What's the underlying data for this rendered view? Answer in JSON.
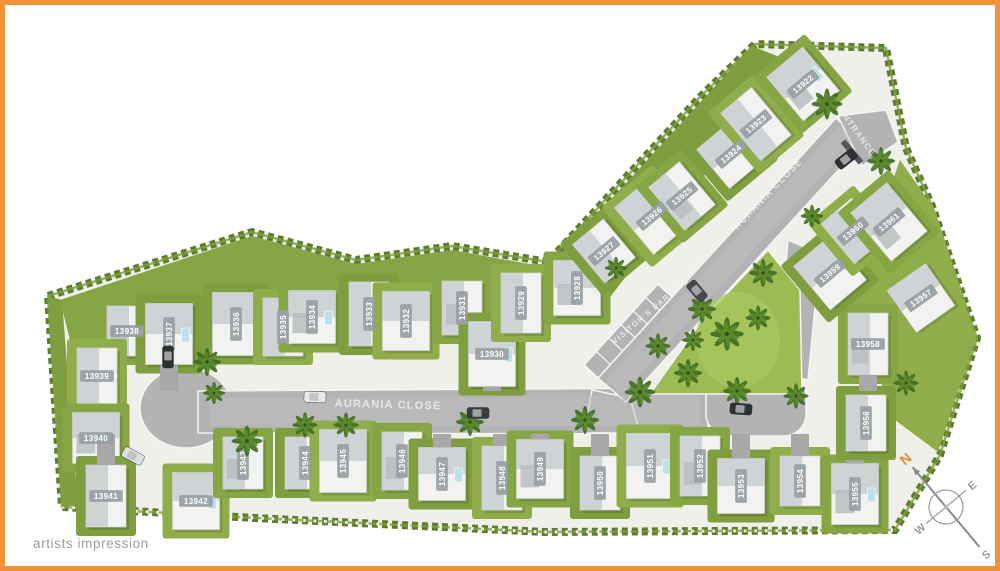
{
  "page": {
    "footer_note": "artists impression",
    "frame_color": "#ef9238",
    "background": "#ffffff"
  },
  "plan": {
    "streets": [
      {
        "name": "AURANIA CLOSE",
        "x": 388,
        "y": 408,
        "rotation": 1.5,
        "size": 11
      },
      {
        "name": "AURANIA CLOSE",
        "x": 770,
        "y": 196,
        "rotation": -46,
        "size": 9.5
      },
      {
        "name": "ENTRANCE",
        "x": 855,
        "y": 134,
        "rotation": 54,
        "size": 8.5
      },
      {
        "name": "VISITOR'S PARKING",
        "x": 652,
        "y": 313,
        "rotation": -40,
        "size": 8
      }
    ],
    "compass": {
      "n": "N",
      "e": "E",
      "s": "S",
      "w": "W",
      "north_color": "#e08a3a",
      "x": 946,
      "y": 507,
      "rotation": -40
    },
    "lots": [
      {
        "id": "13938",
        "x": 127,
        "y": 331,
        "r": 0
      },
      {
        "id": "13937",
        "x": 169,
        "y": 334,
        "r": -90
      },
      {
        "id": "13939",
        "x": 97,
        "y": 376,
        "r": 0
      },
      {
        "id": "13940",
        "x": 96,
        "y": 438,
        "r": 0
      },
      {
        "id": "13941",
        "x": 106,
        "y": 496,
        "r": 0
      },
      {
        "id": "13942",
        "x": 196,
        "y": 501,
        "r": 0
      },
      {
        "id": "13943",
        "x": 243,
        "y": 463,
        "r": -90
      },
      {
        "id": "13936",
        "x": 236,
        "y": 324,
        "r": -90
      },
      {
        "id": "13935",
        "x": 283,
        "y": 327,
        "r": -90
      },
      {
        "id": "13934",
        "x": 312,
        "y": 317,
        "r": -90
      },
      {
        "id": "13933",
        "x": 369,
        "y": 314,
        "r": -90
      },
      {
        "id": "13932",
        "x": 406,
        "y": 321,
        "r": -90
      },
      {
        "id": "13931",
        "x": 462,
        "y": 308,
        "r": -90
      },
      {
        "id": "13930",
        "x": 492,
        "y": 354,
        "r": 0
      },
      {
        "id": "13929",
        "x": 521,
        "y": 303,
        "r": -90
      },
      {
        "id": "13928",
        "x": 577,
        "y": 288,
        "r": -90
      },
      {
        "id": "13927",
        "x": 604,
        "y": 251,
        "r": -40
      },
      {
        "id": "13926",
        "x": 652,
        "y": 216,
        "r": -40
      },
      {
        "id": "13925",
        "x": 682,
        "y": 196,
        "r": -40
      },
      {
        "id": "13924",
        "x": 731,
        "y": 154,
        "r": -40
      },
      {
        "id": "13923",
        "x": 756,
        "y": 124,
        "r": -40
      },
      {
        "id": "13922",
        "x": 803,
        "y": 84,
        "r": -40
      },
      {
        "id": "13944",
        "x": 305,
        "y": 463,
        "r": -90
      },
      {
        "id": "13945",
        "x": 343,
        "y": 461,
        "r": -90
      },
      {
        "id": "13946",
        "x": 402,
        "y": 461,
        "r": -90
      },
      {
        "id": "13947",
        "x": 442,
        "y": 474,
        "r": -90
      },
      {
        "id": "13948",
        "x": 502,
        "y": 478,
        "r": -90
      },
      {
        "id": "13949",
        "x": 540,
        "y": 469,
        "r": -90
      },
      {
        "id": "13950",
        "x": 600,
        "y": 483,
        "r": -90
      },
      {
        "id": "13951",
        "x": 650,
        "y": 466,
        "r": -90
      },
      {
        "id": "13952",
        "x": 700,
        "y": 466,
        "r": -90
      },
      {
        "id": "13953",
        "x": 741,
        "y": 486,
        "r": -90
      },
      {
        "id": "13954",
        "x": 800,
        "y": 481,
        "r": -90
      },
      {
        "id": "13955",
        "x": 855,
        "y": 494,
        "r": -90
      },
      {
        "id": "13956",
        "x": 866,
        "y": 423,
        "r": -90
      },
      {
        "id": "13957",
        "x": 921,
        "y": 298,
        "r": -35
      },
      {
        "id": "13958",
        "x": 868,
        "y": 344,
        "r": 0
      },
      {
        "id": "13959",
        "x": 830,
        "y": 273,
        "r": -40
      },
      {
        "id": "13960",
        "x": 853,
        "y": 231,
        "r": -40
      },
      {
        "id": "13961",
        "x": 889,
        "y": 222,
        "r": -40
      }
    ],
    "colors": {
      "ground": "#eef0e9",
      "road": "#b3b3b3",
      "road_light": "#c2c2c2",
      "curb": "#f5f5f5",
      "hedge": "#5d7c30",
      "hedge_light": "#7da03c",
      "lawns": [
        "#86a645",
        "#7e9e3f",
        "#8fae4b"
      ],
      "park": "#9cbb53",
      "park_light": "#aac75f",
      "house": "#f2f3f1",
      "roof": "#ced3d5",
      "roof_dark": "#b9bdbf",
      "pool": "#bfe0e8",
      "label_bg": "#9ba2a6",
      "label_text": "#ffffff",
      "street_text": "#f2f2f2",
      "compass_gray": "#999999",
      "palm_dark": "#3f6a1f",
      "palm_mid": "#5d8c2d"
    }
  }
}
